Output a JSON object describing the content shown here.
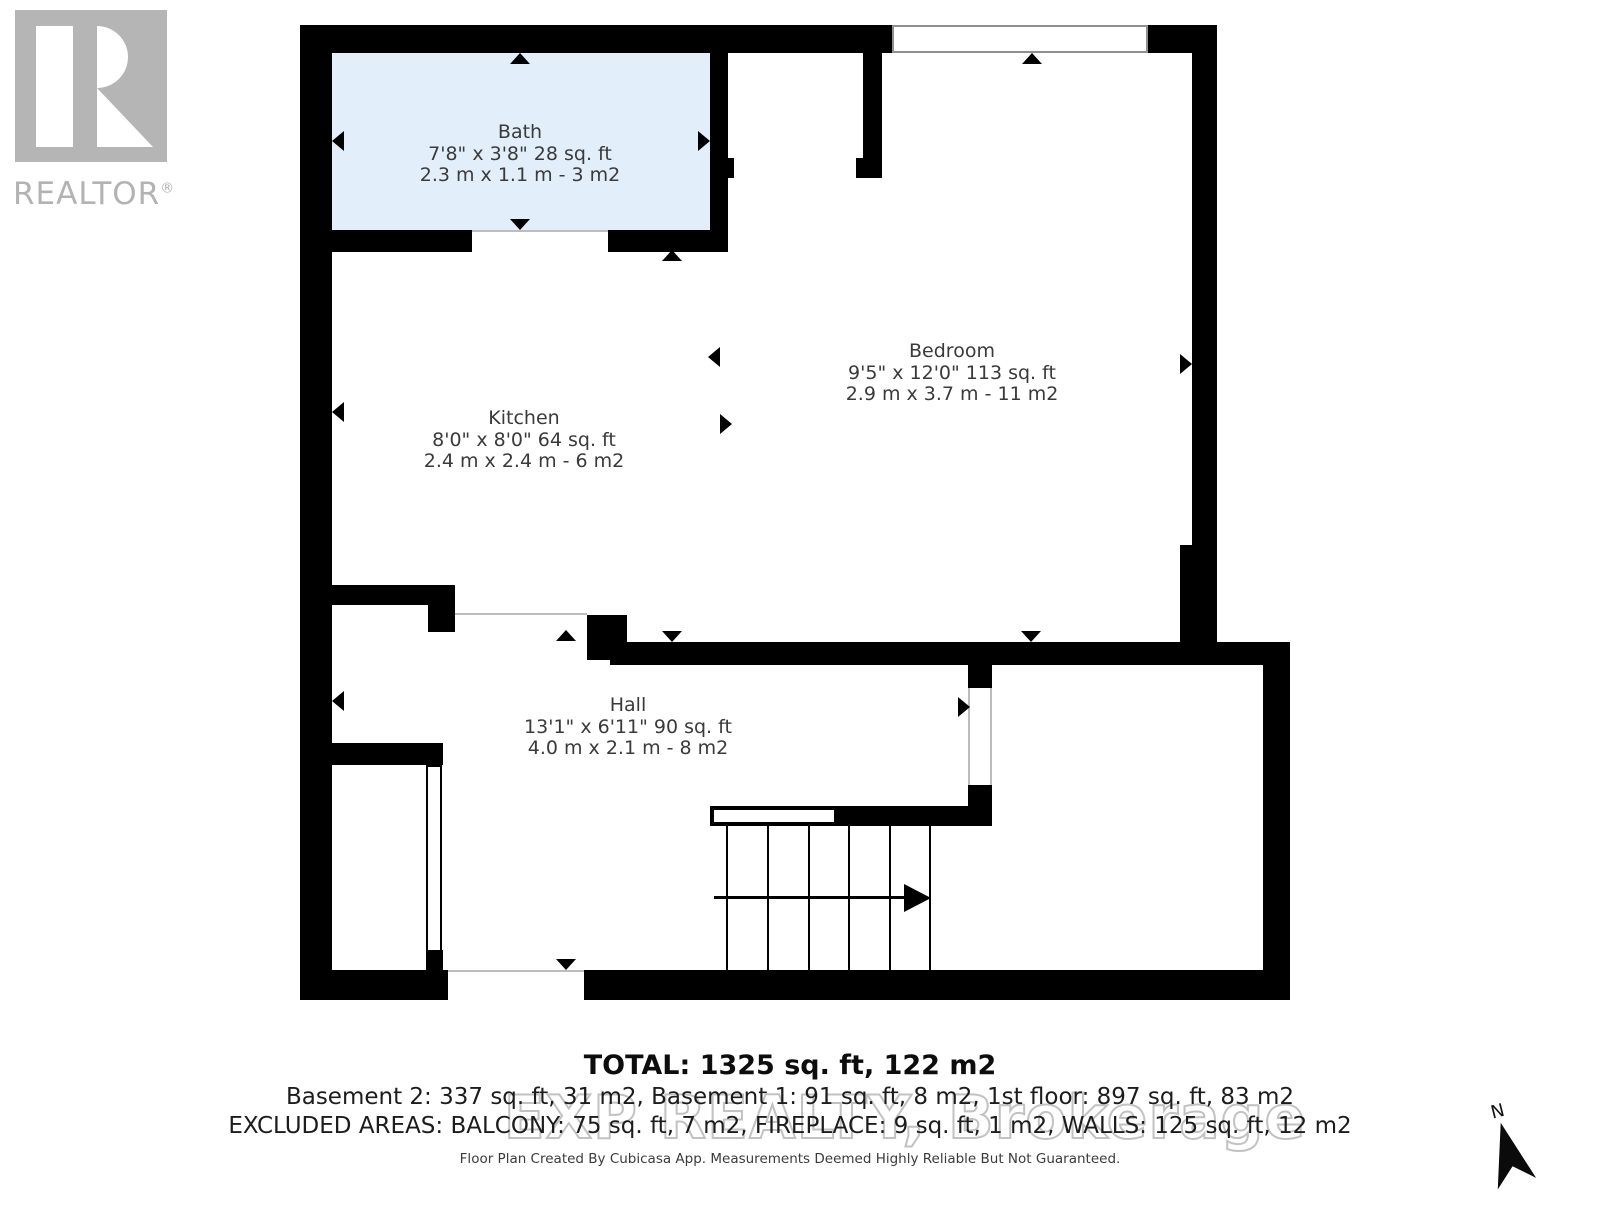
{
  "logo": {
    "brand": "REALTOR",
    "registered": "®"
  },
  "rooms": [
    {
      "id": "bath",
      "name": "Bath",
      "imperial": "7'8\" x 3'8\" 28 sq. ft",
      "metric": "2.3 m x 1.1 m - 3 m2"
    },
    {
      "id": "kitchen",
      "name": "Kitchen",
      "imperial": "8'0\" x 8'0\" 64 sq. ft",
      "metric": "2.4 m x 2.4 m - 6 m2"
    },
    {
      "id": "bedroom",
      "name": "Bedroom",
      "imperial": "9'5\" x 12'0\" 113 sq. ft",
      "metric": "2.9 m x 3.7 m - 11 m2"
    },
    {
      "id": "hall",
      "name": "Hall",
      "imperial": "13'1\" x 6'11\" 90 sq. ft",
      "metric": "4.0 m x 2.1 m - 8 m2"
    }
  ],
  "summary": {
    "total": "TOTAL: 1325 sq. ft, 122 m2",
    "floors": "Basement 2: 337 sq. ft, 31 m2, Basement 1: 91 sq. ft, 8 m2, 1st floor: 897 sq. ft, 83 m2",
    "excluded": "EXCLUDED AREAS: BALCONY: 75 sq. ft, 7 m2, FIREPLACE: 9 sq. ft, 1 m2, WALLS: 125 sq. ft, 12 m2",
    "disclaimer": "Floor Plan Created By Cubicasa App. Measurements Deemed Highly Reliable But Not Guaranteed."
  },
  "watermark": "EXP REALTY, Brokerage",
  "compass": {
    "label": "N"
  },
  "colors": {
    "wall": "#000000",
    "bath_fill": "#e2effa",
    "logo_gray": "#b3b3b3",
    "label_text": "#3a3a3a",
    "watermark_gray": "#c2c2c2"
  }
}
